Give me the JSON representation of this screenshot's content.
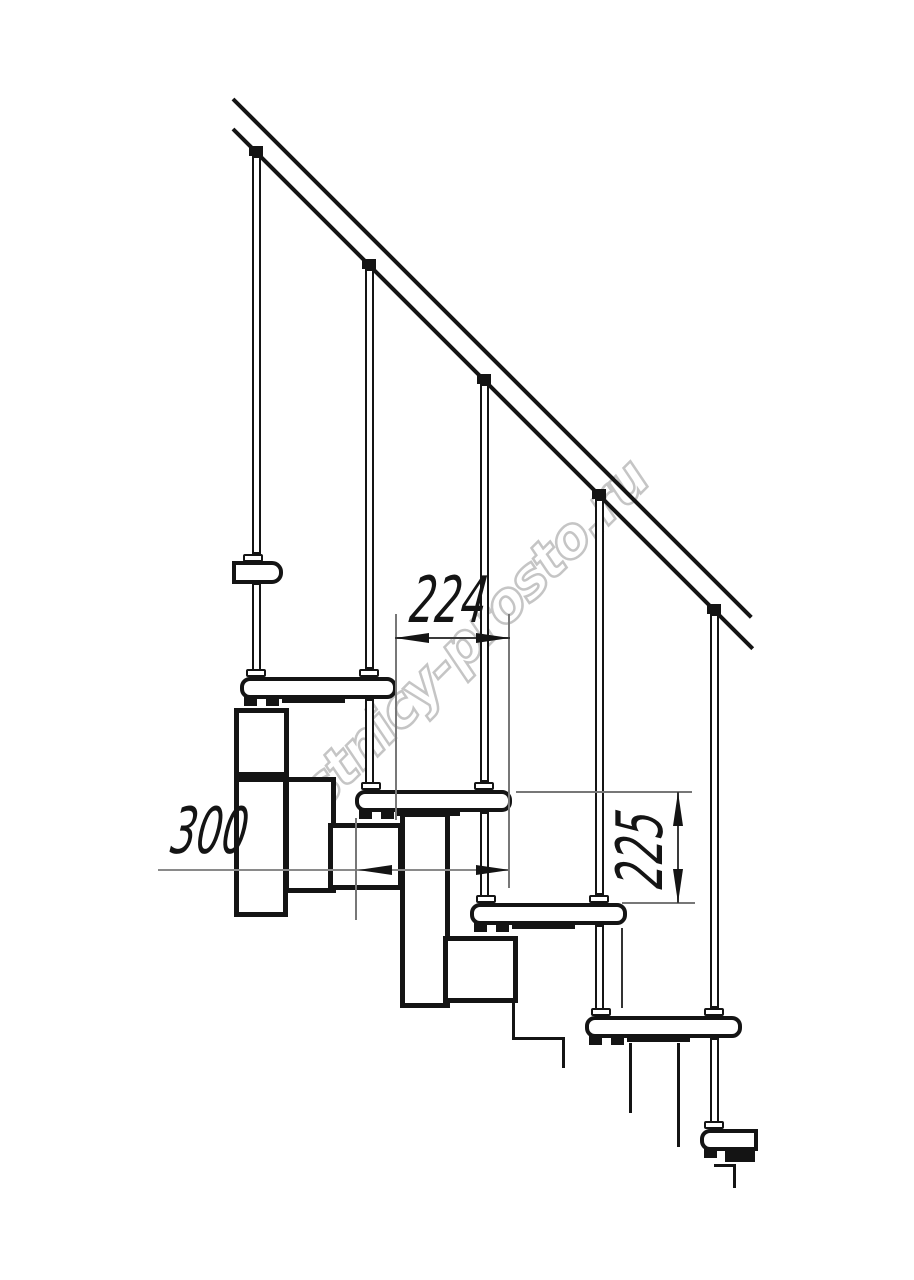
{
  "page": {
    "background": "#ffffff",
    "description": "Side-view CAD technical drawing of a modular staircase fragment: sloped handrail, five balusters, five treads with step-module understructure, and three dimension callouts"
  },
  "ink": "#141414",
  "watermark": {
    "text": "lestnicy-prosto.ru",
    "color": "#c5c5c5",
    "angle_deg": -45
  },
  "dimensions": {
    "run": {
      "value": "224",
      "meaning": "horizontal step run between treads, mm"
    },
    "depth": {
      "value": "300",
      "meaning": "tread depth, mm"
    },
    "rise": {
      "value": "225",
      "meaning": "vertical step rise, mm"
    }
  },
  "geometry": {
    "diagonals": [
      {
        "n": "handrail-top-line",
        "x": 233,
        "y": 97,
        "len": 733,
        "th": 4
      },
      {
        "n": "handrail-bottom-line",
        "x": 233,
        "y": 127,
        "len": 735,
        "th": 4
      }
    ],
    "boxes": [
      {
        "n": "baluster-1-upper",
        "x": 252,
        "y": 156,
        "w": 9,
        "h": 398,
        "bw": 2
      },
      {
        "n": "baluster-2-upper",
        "x": 365,
        "y": 269,
        "w": 9,
        "h": 400,
        "bw": 2
      },
      {
        "n": "baluster-3-upper",
        "x": 480,
        "y": 384,
        "w": 9,
        "h": 398,
        "bw": 2
      },
      {
        "n": "baluster-4-upper",
        "x": 595,
        "y": 499,
        "w": 9,
        "h": 396,
        "bw": 2
      },
      {
        "n": "baluster-5-upper",
        "x": 710,
        "y": 614,
        "w": 9,
        "h": 394,
        "bw": 2
      },
      {
        "n": "tread-rod-1",
        "x": 252,
        "y": 583,
        "w": 9,
        "h": 94,
        "bw": 2
      },
      {
        "n": "tread-rod-2",
        "x": 365,
        "y": 699,
        "w": 9,
        "h": 91,
        "bw": 2
      },
      {
        "n": "tread-rod-3",
        "x": 480,
        "y": 812,
        "w": 9,
        "h": 91,
        "bw": 2
      },
      {
        "n": "tread-rod-4",
        "x": 595,
        "y": 925,
        "w": 9,
        "h": 91,
        "bw": 2
      },
      {
        "n": "tread-rod-5",
        "x": 710,
        "y": 1038,
        "w": 9,
        "h": 91,
        "bw": 2
      },
      {
        "n": "stringer-module-top",
        "x": 234,
        "y": 708,
        "w": 55,
        "h": 69,
        "bw": 5
      },
      {
        "n": "stringer-module-top-leg",
        "x": 234,
        "y": 777,
        "w": 54,
        "h": 140,
        "bw": 5
      },
      {
        "n": "stringer-connector-1",
        "x": 284,
        "y": 777,
        "w": 52,
        "h": 116,
        "bw": 5
      },
      {
        "n": "stringer-connector-2",
        "x": 400,
        "y": 812,
        "w": 50,
        "h": 196,
        "bw": 5
      },
      {
        "n": "stringer-module-2",
        "x": 328,
        "y": 823,
        "w": 75,
        "h": 67,
        "bw": 5
      },
      {
        "n": "stringer-module-3",
        "x": 443,
        "y": 936,
        "w": 75,
        "h": 67,
        "bw": 5
      },
      {
        "n": "tread-upper-cut",
        "x": 232,
        "y": 561,
        "w": 51,
        "h": 23,
        "bw": 4,
        "r": "0 11px 11px 0"
      },
      {
        "n": "tread-1",
        "x": 240,
        "y": 677,
        "w": 157,
        "h": 22,
        "bw": 4,
        "r": "10px"
      },
      {
        "n": "tread-2",
        "x": 355,
        "y": 790,
        "w": 157,
        "h": 22,
        "bw": 4,
        "r": "10px"
      },
      {
        "n": "tread-3",
        "x": 470,
        "y": 903,
        "w": 157,
        "h": 22,
        "bw": 4,
        "r": "10px"
      },
      {
        "n": "tread-4",
        "x": 585,
        "y": 1016,
        "w": 157,
        "h": 22,
        "bw": 4,
        "r": "10px"
      },
      {
        "n": "tread-5-cut",
        "x": 700,
        "y": 1129,
        "w": 58,
        "h": 22,
        "bw": 4,
        "r": "10px 0 0 10px"
      },
      {
        "n": "baluster-1-collar",
        "x": 243,
        "y": 554,
        "w": 20,
        "h": 8,
        "bw": 2,
        "r": "2px"
      },
      {
        "n": "baluster-2-collar",
        "x": 359,
        "y": 669,
        "w": 20,
        "h": 8,
        "bw": 2,
        "r": "2px"
      },
      {
        "n": "baluster-3-collar",
        "x": 474,
        "y": 782,
        "w": 20,
        "h": 8,
        "bw": 2,
        "r": "2px"
      },
      {
        "n": "baluster-4-collar",
        "x": 589,
        "y": 895,
        "w": 20,
        "h": 8,
        "bw": 2,
        "r": "2px"
      },
      {
        "n": "baluster-5-collar",
        "x": 704,
        "y": 1008,
        "w": 20,
        "h": 8,
        "bw": 2,
        "r": "2px"
      },
      {
        "n": "rod-1-collar",
        "x": 246,
        "y": 669,
        "w": 20,
        "h": 8,
        "bw": 2,
        "r": "2px"
      },
      {
        "n": "rod-2-collar",
        "x": 361,
        "y": 782,
        "w": 20,
        "h": 8,
        "bw": 2,
        "r": "2px"
      },
      {
        "n": "rod-3-collar",
        "x": 476,
        "y": 895,
        "w": 20,
        "h": 8,
        "bw": 2,
        "r": "2px"
      },
      {
        "n": "rod-4-collar",
        "x": 591,
        "y": 1008,
        "w": 20,
        "h": 8,
        "bw": 2,
        "r": "2px"
      },
      {
        "n": "rod-5-collar",
        "x": 704,
        "y": 1121,
        "w": 20,
        "h": 8,
        "bw": 2,
        "r": "2px"
      }
    ],
    "rects": [
      {
        "n": "baluster-1-cap",
        "x": 249,
        "y": 146,
        "w": 14,
        "h": 10
      },
      {
        "n": "baluster-2-cap",
        "x": 362,
        "y": 259,
        "w": 14,
        "h": 10
      },
      {
        "n": "baluster-3-cap",
        "x": 477,
        "y": 374,
        "w": 14,
        "h": 10
      },
      {
        "n": "baluster-4-cap",
        "x": 592,
        "y": 489,
        "w": 14,
        "h": 10
      },
      {
        "n": "baluster-5-cap",
        "x": 707,
        "y": 604,
        "w": 14,
        "h": 10
      },
      {
        "n": "tread-1-clamp-a",
        "x": 244,
        "y": 697,
        "w": 13,
        "h": 9
      },
      {
        "n": "tread-1-clamp-b",
        "x": 266,
        "y": 697,
        "w": 13,
        "h": 9
      },
      {
        "n": "tread-1-mount-bar",
        "x": 282,
        "y": 697,
        "w": 63,
        "h": 6
      },
      {
        "n": "tread-2-clamp-a",
        "x": 359,
        "y": 810,
        "w": 13,
        "h": 9
      },
      {
        "n": "tread-2-clamp-b",
        "x": 381,
        "y": 810,
        "w": 13,
        "h": 9
      },
      {
        "n": "tread-2-mount-bar",
        "x": 397,
        "y": 810,
        "w": 63,
        "h": 6
      },
      {
        "n": "tread-3-clamp-a",
        "x": 474,
        "y": 923,
        "w": 13,
        "h": 9
      },
      {
        "n": "tread-3-clamp-b",
        "x": 496,
        "y": 923,
        "w": 13,
        "h": 9
      },
      {
        "n": "tread-3-mount-bar",
        "x": 512,
        "y": 923,
        "w": 63,
        "h": 6
      },
      {
        "n": "tread-4-clamp-a",
        "x": 589,
        "y": 1036,
        "w": 13,
        "h": 9
      },
      {
        "n": "tread-4-clamp-b",
        "x": 611,
        "y": 1036,
        "w": 13,
        "h": 9
      },
      {
        "n": "tread-4-mount-bar",
        "x": 627,
        "y": 1036,
        "w": 63,
        "h": 6
      },
      {
        "n": "tread-5-clamp-a",
        "x": 704,
        "y": 1149,
        "w": 13,
        "h": 9
      },
      {
        "n": "tread-5-mount-block",
        "x": 725,
        "y": 1149,
        "w": 30,
        "h": 13
      },
      {
        "n": "cut-line-under-module-3-v1",
        "x": 512,
        "y": 1003,
        "w": 3,
        "h": 37
      },
      {
        "n": "cut-line-under-module-3-h",
        "x": 512,
        "y": 1037,
        "w": 53,
        "h": 3
      },
      {
        "n": "cut-line-under-module-3-v2",
        "x": 562,
        "y": 1037,
        "w": 3,
        "h": 31
      },
      {
        "n": "cut-line-under-tread-4-a",
        "x": 629,
        "y": 1043,
        "w": 3,
        "h": 70
      },
      {
        "n": "cut-line-under-tread-4-b",
        "x": 677,
        "y": 1043,
        "w": 3,
        "h": 104
      },
      {
        "n": "cut-line-under-tread-3",
        "x": 621,
        "y": 928,
        "w": 2,
        "h": 80,
        "c": "#333333"
      },
      {
        "n": "cut-line-under-tread-5-h",
        "x": 714,
        "y": 1164,
        "w": 22,
        "h": 3
      },
      {
        "n": "cut-line-under-tread-5-v",
        "x": 733,
        "y": 1164,
        "w": 3,
        "h": 24
      },
      {
        "n": "dim-run-ext-left",
        "x": 395,
        "y": 614,
        "w": 2,
        "h": 206,
        "c": "#777777"
      },
      {
        "n": "dim-run-ext-right",
        "x": 508,
        "y": 614,
        "w": 2,
        "h": 274,
        "c": "#777777"
      },
      {
        "n": "dim-run-line",
        "x": 395,
        "y": 637,
        "w": 115,
        "h": 2,
        "c": "#3a3a3a"
      },
      {
        "n": "dim-depth-line",
        "x": 158,
        "y": 869,
        "w": 352,
        "h": 2,
        "c": "#8a8a8a"
      },
      {
        "n": "dim-depth-ext",
        "x": 355,
        "y": 818,
        "w": 2,
        "h": 102,
        "c": "#777777"
      },
      {
        "n": "dim-rise-ext-top",
        "x": 516,
        "y": 791,
        "w": 176,
        "h": 2,
        "c": "#777777"
      },
      {
        "n": "dim-rise-ext-bottom",
        "x": 622,
        "y": 902,
        "w": 73,
        "h": 2,
        "c": "#777777"
      },
      {
        "n": "dim-rise-line",
        "x": 677,
        "y": 792,
        "w": 2,
        "h": 111,
        "c": "#3a3a3a"
      }
    ],
    "arrows": [
      {
        "n": "dim-run-arrow-left",
        "x": 395,
        "y": 638,
        "d": "left"
      },
      {
        "n": "dim-run-arrow-right",
        "x": 510,
        "y": 638,
        "d": "right"
      },
      {
        "n": "dim-depth-arrow-left",
        "x": 358,
        "y": 870,
        "d": "left"
      },
      {
        "n": "dim-depth-arrow-right",
        "x": 510,
        "y": 870,
        "d": "right"
      },
      {
        "n": "dim-rise-arrow-up",
        "x": 678,
        "y": 792,
        "d": "up"
      },
      {
        "n": "dim-rise-arrow-down",
        "x": 678,
        "y": 903,
        "d": "down"
      }
    ]
  }
}
